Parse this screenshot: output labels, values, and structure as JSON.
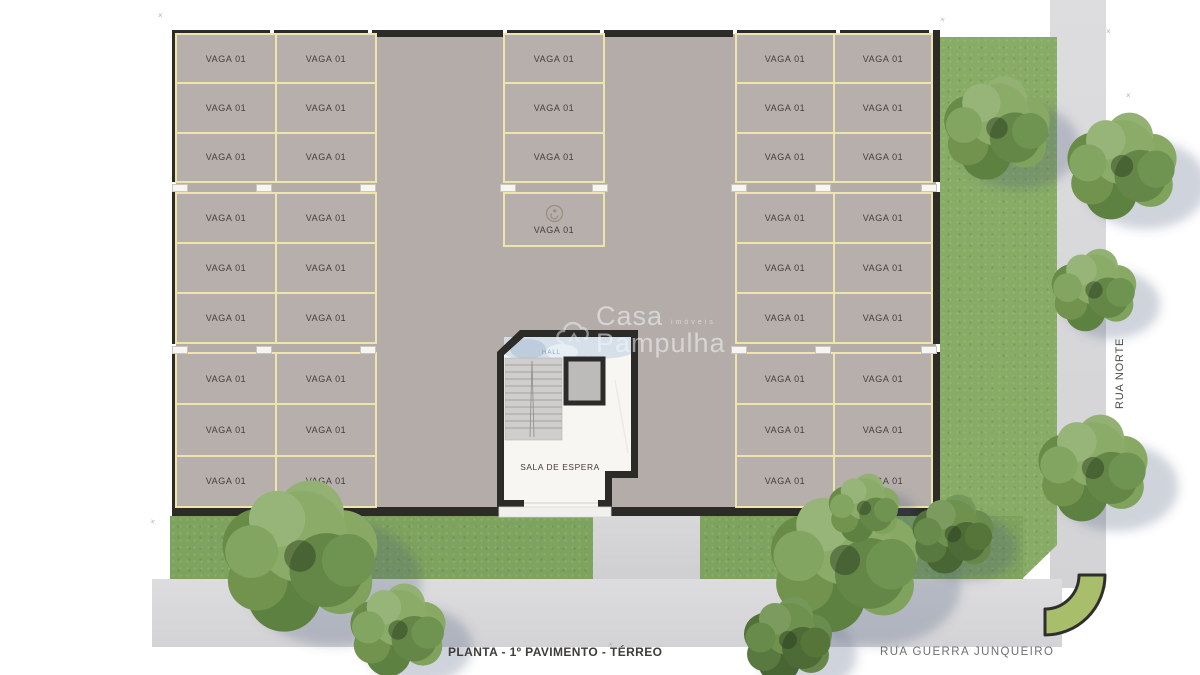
{
  "plan": {
    "title": "PLANTA - 1º PAVIMENTO - TÉRREO",
    "streets": {
      "bottom": "RUA GUERRA JUNQUEIRO",
      "right": "RUA NORTE"
    },
    "watermark": {
      "brand_top": "Casa",
      "brand_bottom": "Pampulha",
      "tagline": "imóveis",
      "cloud_icon": "cloud-logo-icon"
    },
    "rooms": {
      "hall": "HALL",
      "waiting_room": "SALA DE ESPERA"
    },
    "parking": {
      "stall_label": "VAGA 01",
      "accessible_icon": "accessible-parking-icon",
      "blocks": [
        {
          "id": "left-top",
          "cols": 2,
          "rows": 3
        },
        {
          "id": "left-middle",
          "cols": 2,
          "rows": 3
        },
        {
          "id": "left-bottom",
          "cols": 2,
          "rows": 3
        },
        {
          "id": "center-top",
          "cols": 1,
          "rows": 3
        },
        {
          "id": "center-accessible",
          "cols": 1,
          "rows": 1,
          "accessible": true
        },
        {
          "id": "right-top",
          "cols": 2,
          "rows": 3
        },
        {
          "id": "right-middle",
          "cols": 2,
          "rows": 3
        },
        {
          "id": "right-bottom",
          "cols": 2,
          "rows": 3
        }
      ],
      "total_stalls": 40
    },
    "marks_glyph": "×",
    "colors": {
      "floor": "#b3aca8",
      "stall": "#b6afab",
      "line": "#efe4ab",
      "wall": "#2c2b28",
      "grass": "#7ea35e",
      "grass_light": "#88ac66",
      "sidewalk": "#d9d9db",
      "curb_green": "#a8be6a",
      "hall_blue": "#d4dee7",
      "text_dark": "#44403c",
      "text_gray": "#6f6f6f",
      "watermark": "rgba(242,247,252,0.55)"
    }
  }
}
